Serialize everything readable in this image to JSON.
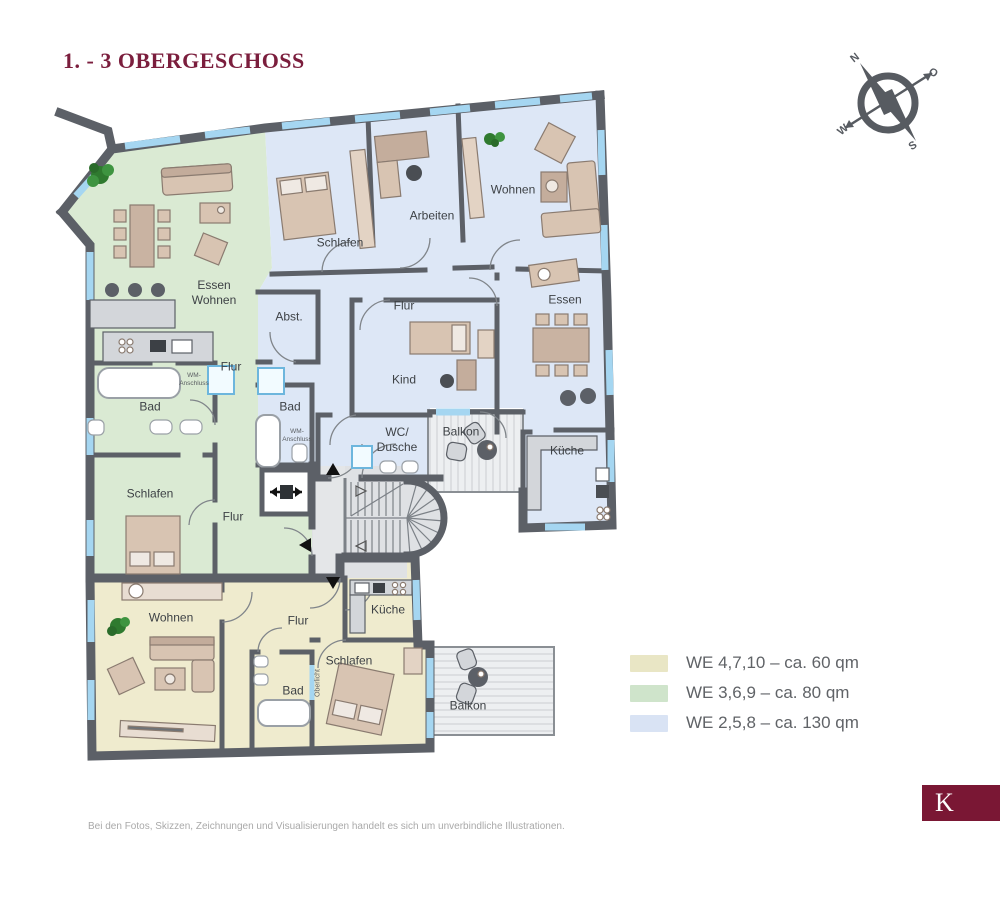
{
  "title": "1. - 3 OBERGESCHOSS",
  "compass": {
    "north": "N",
    "east": "O",
    "south": "S",
    "west": "W"
  },
  "plan": {
    "rooms": {
      "green_essen_wohnen": "Essen\nWohnen",
      "green_flur_upper": "Flur",
      "green_bad": "Bad",
      "green_wm": "WM-\nAnschluss",
      "green_schlafen": "Schlafen",
      "green_flur_lower": "Flur",
      "blue_schlafen": "Schlafen",
      "blue_arbeiten": "Arbeiten",
      "blue_wohnen": "Wohnen",
      "blue_flur": "Flur",
      "blue_abst": "Abst.",
      "blue_kind": "Kind",
      "blue_essen": "Essen",
      "blue_bad": "Bad",
      "blue_wm": "WM-\nAnschluss",
      "blue_wc_dusche": "WC/\nDusche",
      "blue_balkon": "Balkon",
      "blue_kueche": "Küche",
      "yellow_wohnen": "Wohnen",
      "yellow_flur": "Flur",
      "yellow_kueche": "Küche",
      "yellow_schlafen": "Schlafen",
      "yellow_bad": "Bad",
      "yellow_oberlicht": "Oberlicht",
      "yellow_balkon": "Balkon"
    },
    "colors": {
      "wall": "#5c6067",
      "window": "#a5d6f1",
      "floor_we_60": "#efebce",
      "floor_we_80": "#daead3",
      "floor_we_130": "#dde7f6",
      "title_accent": "#7b1e3d",
      "logo_bg": "#7a1734"
    }
  },
  "legend": {
    "items": [
      {
        "label": "WE 4,7,10 – ca. 60 qm",
        "color": "#e9e6c5"
      },
      {
        "label": "WE 3,6,9 – ca. 80 qm",
        "color": "#cfe4cb"
      },
      {
        "label": "WE 2,5,8 – ca. 130 qm",
        "color": "#d9e3f4"
      }
    ]
  },
  "footer": {
    "disclaimer": "Bei den Fotos, Skizzen, Zeichnungen und Visualisierungen handelt es sich um unverbindliche Illustrationen."
  },
  "logo": {
    "letter": "K"
  }
}
